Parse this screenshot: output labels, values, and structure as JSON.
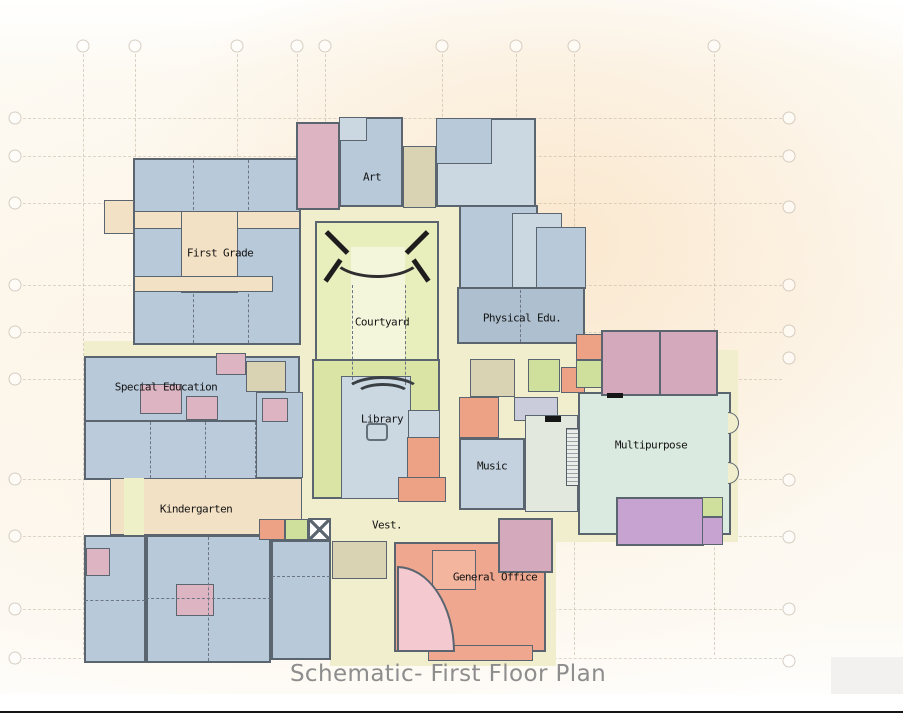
{
  "title": "Schematic- First Floor Plan",
  "colors": {
    "wall": "#5a6570",
    "cy": "#f1eecd",
    "cyl": "#eef0c8",
    "ct": "#f3e1c5",
    "bl": "#b8c9da",
    "bl2": "#bccbdb",
    "bd": "#aec0d0",
    "pb": "#cbd7e1",
    "mb": "#c3d2de",
    "pk": "#ddb4c1",
    "mv": "#d5a9bc",
    "sa": "#eda285",
    "so": "#efa78f",
    "so2": "#f3b59e",
    "cg": "#e9eebd",
    "cgl": "#f4f6dc",
    "lg": "#dae4a4",
    "li": "#cfe09c",
    "tl": "#dbeae0",
    "sg": "#e2e8de",
    "pu": "#c6a3d1",
    "lv": "#caccdb",
    "kh": "#d9d3b4",
    "gr": "#f2f1ef",
    "white": "#ffffff",
    "grid": "#bdb19e",
    "title_gray": "#8d8d8d",
    "label_black": "#141414"
  },
  "plan": {
    "grid": {
      "vx": [
        83,
        135,
        237,
        297,
        325,
        442,
        516,
        574,
        714
      ],
      "vy0": 54,
      "vy1": 655,
      "top_cy": 46,
      "hy": [
        118,
        156,
        203,
        285,
        332,
        379,
        479,
        536,
        609,
        658
      ],
      "hx0": 23,
      "hx1": 782,
      "left_cx": 15,
      "right_cx": 789,
      "right_hy": [
        118,
        156,
        207,
        285,
        331,
        358,
        480,
        537,
        609,
        661
      ]
    },
    "blocks": [
      {
        "id": "corridor-central",
        "x": 296,
        "y": 198,
        "w": 168,
        "h": 366,
        "f": "cy",
        "b": 1
      },
      {
        "id": "corridor-ew",
        "x": 84,
        "y": 341,
        "w": 556,
        "h": 22,
        "f": "cy",
        "b": 0
      },
      {
        "id": "corridor-art-east",
        "x": 436,
        "y": 138,
        "w": 50,
        "h": 208,
        "f": "cy",
        "b": 0
      },
      {
        "id": "base-south-center",
        "x": 330,
        "y": 494,
        "w": 226,
        "h": 172,
        "f": "cy",
        "b": 0
      },
      {
        "id": "base-east",
        "x": 440,
        "y": 350,
        "w": 298,
        "h": 192,
        "f": "cy",
        "b": 0
      },
      {
        "id": "corridor-fg-west",
        "x": 104,
        "y": 200,
        "w": 32,
        "h": 34,
        "f": "ct",
        "b": 1
      },
      {
        "id": "first-grade-block",
        "x": 133,
        "y": 158,
        "w": 168,
        "h": 187,
        "f": "bl",
        "b": 2
      },
      {
        "id": "fg-corridor-h1",
        "x": 134,
        "y": 211,
        "w": 166,
        "h": 18,
        "f": "ct",
        "b": 1
      },
      {
        "id": "fg-corridor-v",
        "x": 181,
        "y": 211,
        "w": 57,
        "h": 82,
        "f": "ct",
        "b": 1
      },
      {
        "id": "fg-corridor-h2",
        "x": 134,
        "y": 276,
        "w": 139,
        "h": 16,
        "f": "ct",
        "b": 1
      },
      {
        "id": "restroom-north",
        "x": 296,
        "y": 122,
        "w": 44,
        "h": 88,
        "f": "pk",
        "b": 2,
        "hatch": "rest"
      },
      {
        "id": "art-room",
        "x": 339,
        "y": 117,
        "w": 64,
        "h": 90,
        "f": "bl",
        "b": 2
      },
      {
        "id": "art-subroom",
        "x": 339,
        "y": 117,
        "w": 28,
        "h": 24,
        "f": "pb",
        "b": 1
      },
      {
        "id": "stair-art",
        "x": 403,
        "y": 146,
        "w": 33,
        "h": 62,
        "f": "kh",
        "b": 1,
        "hatch": "stair"
      },
      {
        "id": "ne-top-block",
        "x": 436,
        "y": 118,
        "w": 100,
        "h": 89,
        "f": "pb",
        "b": 2
      },
      {
        "id": "ne-top-sub",
        "x": 436,
        "y": 118,
        "w": 56,
        "h": 46,
        "f": "bl",
        "b": 1
      },
      {
        "id": "ne-room-a",
        "x": 459,
        "y": 205,
        "w": 79,
        "h": 84,
        "f": "bl",
        "b": 2
      },
      {
        "id": "ne-room-b",
        "x": 512,
        "y": 213,
        "w": 50,
        "h": 76,
        "f": "pb",
        "b": 1
      },
      {
        "id": "ne-room-c",
        "x": 536,
        "y": 227,
        "w": 50,
        "h": 62,
        "f": "bl",
        "b": 1
      },
      {
        "id": "physical-edu-room",
        "x": 457,
        "y": 287,
        "w": 128,
        "h": 57,
        "f": "bd",
        "b": 2
      },
      {
        "id": "courtyard-area",
        "x": 315,
        "y": 221,
        "w": 124,
        "h": 176,
        "f": "cg",
        "b": 2
      },
      {
        "id": "courtyard-inner",
        "x": 351,
        "y": 247,
        "w": 54,
        "h": 132,
        "f": "cgl",
        "b": 0
      },
      {
        "id": "library-base",
        "x": 312,
        "y": 359,
        "w": 128,
        "h": 140,
        "f": "lg",
        "b": 2
      },
      {
        "id": "library-room",
        "x": 341,
        "y": 376,
        "w": 70,
        "h": 123,
        "f": "pb",
        "b": 1
      },
      {
        "id": "library-east",
        "x": 408,
        "y": 410,
        "w": 32,
        "h": 89,
        "f": "pb",
        "b": 1
      },
      {
        "id": "library-orange-room",
        "x": 407,
        "y": 437,
        "w": 33,
        "h": 62,
        "f": "sa",
        "b": 1
      },
      {
        "id": "special-ed-block",
        "x": 84,
        "y": 356,
        "w": 216,
        "h": 76,
        "f": "bl",
        "b": 2
      },
      {
        "id": "special-ed-row",
        "x": 84,
        "y": 420,
        "w": 216,
        "h": 60,
        "f": "bl2",
        "b": 2
      },
      {
        "id": "spec-pink-1",
        "x": 140,
        "y": 384,
        "w": 42,
        "h": 30,
        "f": "pk",
        "b": 1,
        "hatch": "rest"
      },
      {
        "id": "spec-pink-2",
        "x": 186,
        "y": 396,
        "w": 32,
        "h": 24,
        "f": "pk",
        "b": 1
      },
      {
        "id": "spec-pink-3",
        "x": 216,
        "y": 353,
        "w": 30,
        "h": 22,
        "f": "pk",
        "b": 1
      },
      {
        "id": "stair-special-ed",
        "x": 246,
        "y": 361,
        "w": 40,
        "h": 31,
        "f": "kh",
        "b": 1,
        "hatch": "stair"
      },
      {
        "id": "spec-east-room",
        "x": 256,
        "y": 392,
        "w": 47,
        "h": 86,
        "f": "bl",
        "b": 1
      },
      {
        "id": "spec-east-pink",
        "x": 262,
        "y": 398,
        "w": 26,
        "h": 24,
        "f": "pk",
        "b": 1
      },
      {
        "id": "kg-corridor",
        "x": 110,
        "y": 478,
        "w": 192,
        "h": 57,
        "f": "ct",
        "b": 1
      },
      {
        "id": "kg-corridor-strip",
        "x": 124,
        "y": 478,
        "w": 20,
        "h": 133,
        "f": "cyl",
        "b": 0
      },
      {
        "id": "kg-left-block",
        "x": 84,
        "y": 535,
        "w": 62,
        "h": 128,
        "f": "bl",
        "b": 2
      },
      {
        "id": "kg-left-pink",
        "x": 86,
        "y": 548,
        "w": 24,
        "h": 28,
        "f": "pk",
        "b": 1
      },
      {
        "id": "kg-main-block",
        "x": 146,
        "y": 535,
        "w": 125,
        "h": 128,
        "f": "bl",
        "b": 2
      },
      {
        "id": "kg-center-pink",
        "x": 176,
        "y": 584,
        "w": 38,
        "h": 32,
        "f": "pk",
        "b": 1,
        "hatch": "rest"
      },
      {
        "id": "kg-east-block",
        "x": 271,
        "y": 540,
        "w": 60,
        "h": 120,
        "f": "bl",
        "b": 2
      },
      {
        "id": "vest-salmon-room",
        "x": 259,
        "y": 519,
        "w": 26,
        "h": 21,
        "f": "sa",
        "b": 1
      },
      {
        "id": "vest-green-room",
        "x": 285,
        "y": 519,
        "w": 23,
        "h": 21,
        "f": "li",
        "b": 1
      },
      {
        "id": "stair-vest",
        "x": 332,
        "y": 541,
        "w": 55,
        "h": 38,
        "f": "kh",
        "b": 1,
        "hatch": "stair"
      },
      {
        "id": "go-salmon-top",
        "x": 398,
        "y": 477,
        "w": 48,
        "h": 25,
        "f": "sa",
        "b": 1
      },
      {
        "id": "general-office-block",
        "x": 394,
        "y": 542,
        "w": 152,
        "h": 110,
        "f": "so",
        "b": 2
      },
      {
        "id": "go-lower-ext",
        "x": 428,
        "y": 645,
        "w": 105,
        "h": 16,
        "f": "so",
        "b": 1
      },
      {
        "id": "go-inner-room",
        "x": 432,
        "y": 550,
        "w": 44,
        "h": 40,
        "f": "so2",
        "b": 1
      },
      {
        "id": "go-restroom",
        "x": 498,
        "y": 518,
        "w": 55,
        "h": 55,
        "f": "mv",
        "b": 2,
        "hatch": "rest"
      },
      {
        "id": "stair-music",
        "x": 470,
        "y": 359,
        "w": 45,
        "h": 38,
        "f": "kh",
        "b": 1,
        "hatch": "stair"
      },
      {
        "id": "music-salmon-room",
        "x": 459,
        "y": 397,
        "w": 40,
        "h": 41,
        "f": "sa",
        "b": 1
      },
      {
        "id": "music-lavender-room",
        "x": 514,
        "y": 397,
        "w": 44,
        "h": 24,
        "f": "lv",
        "b": 1
      },
      {
        "id": "music-green-room",
        "x": 528,
        "y": 359,
        "w": 32,
        "h": 33,
        "f": "li",
        "b": 1
      },
      {
        "id": "east-salmon-small",
        "x": 561,
        "y": 367,
        "w": 24,
        "h": 26,
        "f": "sa",
        "b": 1
      },
      {
        "id": "east-green-small",
        "x": 602,
        "y": 358,
        "w": 22,
        "h": 20,
        "f": "li",
        "b": 1
      },
      {
        "id": "east-lavender-small",
        "x": 602,
        "y": 376,
        "w": 22,
        "h": 16,
        "f": "lv",
        "b": 1
      },
      {
        "id": "music-room",
        "x": 459,
        "y": 438,
        "w": 66,
        "h": 72,
        "f": "mb",
        "b": 2
      },
      {
        "id": "stage-area",
        "x": 525,
        "y": 415,
        "w": 53,
        "h": 97,
        "f": "sg",
        "b": 1
      },
      {
        "id": "multipurpose-room",
        "x": 578,
        "y": 392,
        "w": 153,
        "h": 143,
        "f": "tl",
        "b": 2
      },
      {
        "id": "mp-restrooms",
        "x": 601,
        "y": 330,
        "w": 117,
        "h": 66,
        "f": "mv",
        "b": 2,
        "hatch": "rest"
      },
      {
        "id": "mp-salmon-small",
        "x": 576,
        "y": 334,
        "w": 26,
        "h": 26,
        "f": "sa",
        "b": 1
      },
      {
        "id": "mp-green-small",
        "x": 576,
        "y": 360,
        "w": 26,
        "h": 28,
        "f": "li",
        "b": 1
      },
      {
        "id": "stage-room-purple",
        "x": 616,
        "y": 497,
        "w": 88,
        "h": 49,
        "f": "pu",
        "b": 2
      },
      {
        "id": "purple-green-small",
        "x": 702,
        "y": 497,
        "w": 21,
        "h": 20,
        "f": "li",
        "b": 1
      },
      {
        "id": "purple-east-small",
        "x": 702,
        "y": 517,
        "w": 21,
        "h": 28,
        "f": "pu",
        "b": 1
      },
      {
        "id": "corner-gray-block",
        "x": 831,
        "y": 657,
        "w": 72,
        "h": 54,
        "f": "gr",
        "b": 0
      },
      {
        "id": "bottom-margin",
        "x": 0,
        "y": 694,
        "w": 903,
        "h": 28,
        "f": "white",
        "b": 0
      }
    ],
    "decor": [
      {
        "id": "courtyard-arc-top",
        "k": "arcB",
        "x": 330,
        "y": 230,
        "w": 94,
        "h": 48
      },
      {
        "id": "courtyard-wall-bar-1",
        "k": "bar",
        "x": 322,
        "y": 240,
        "w": 30,
        "h": 5,
        "r": 45
      },
      {
        "id": "courtyard-wall-bar-2",
        "k": "bar",
        "x": 402,
        "y": 240,
        "w": 30,
        "h": 5,
        "r": -45
      },
      {
        "id": "courtyard-wall-bar-3",
        "k": "bar",
        "x": 320,
        "y": 268,
        "w": 26,
        "h": 5,
        "r": -55
      },
      {
        "id": "courtyard-wall-bar-4",
        "k": "bar",
        "x": 408,
        "y": 268,
        "w": 26,
        "h": 5,
        "r": 55
      },
      {
        "id": "courtyard-dash-left",
        "k": "vdash",
        "x": 352,
        "y": 285,
        "h": 100
      },
      {
        "id": "courtyard-dash-right",
        "k": "vdash",
        "x": 405,
        "y": 285,
        "h": 100
      },
      {
        "id": "amphitheater-arc-outer",
        "k": "arcT",
        "x": 344,
        "y": 376,
        "w": 78,
        "h": 34
      },
      {
        "id": "amphitheater-arc-inner",
        "k": "arcT",
        "x": 355,
        "y": 383,
        "w": 56,
        "h": 24
      },
      {
        "id": "library-table-icon",
        "k": "table",
        "x": 366,
        "y": 423,
        "w": 22,
        "h": 18
      },
      {
        "id": "fg-dash-1",
        "k": "vdash",
        "x": 193,
        "y": 160,
        "h": 50
      },
      {
        "id": "fg-dash-2",
        "k": "vdash",
        "x": 248,
        "y": 160,
        "h": 50
      },
      {
        "id": "fg-dash-3",
        "k": "vdash",
        "x": 193,
        "y": 294,
        "h": 49
      },
      {
        "id": "fg-dash-4",
        "k": "vdash",
        "x": 248,
        "y": 294,
        "h": 49
      },
      {
        "id": "spec-dash-1",
        "k": "vdash",
        "x": 150,
        "y": 422,
        "h": 56
      },
      {
        "id": "spec-dash-2",
        "k": "vdash",
        "x": 205,
        "y": 422,
        "h": 56
      },
      {
        "id": "spec-dash-3",
        "k": "vdash",
        "x": 255,
        "y": 422,
        "h": 56
      },
      {
        "id": "physed-dash",
        "k": "vdash",
        "x": 520,
        "y": 290,
        "h": 52
      },
      {
        "id": "kg-dash-1",
        "k": "vdash",
        "x": 208,
        "y": 537,
        "h": 124
      },
      {
        "id": "kg-dash-2",
        "k": "hdash",
        "x": 146,
        "y": 598,
        "w": 125
      },
      {
        "id": "kg-east-dash",
        "k": "hdash",
        "x": 272,
        "y": 576,
        "w": 58
      },
      {
        "id": "kg-left-dash",
        "k": "hdash",
        "x": 85,
        "y": 600,
        "w": 60
      },
      {
        "id": "stair-xbox",
        "k": "xbox",
        "x": 308,
        "y": 518,
        "w": 23,
        "h": 23
      },
      {
        "id": "entry-wedge",
        "k": "wedge",
        "x": 397,
        "y": 566,
        "w": 58,
        "h": 86
      },
      {
        "id": "stage-stairs-strip",
        "k": "shatch",
        "x": 566,
        "y": 428,
        "w": 13,
        "h": 58
      },
      {
        "id": "stage-mark",
        "k": "mark",
        "x": 545,
        "y": 416,
        "w": 16,
        "h": 6
      },
      {
        "id": "mp-mark",
        "k": "mark",
        "x": 607,
        "y": 393,
        "w": 16,
        "h": 5
      },
      {
        "id": "mp-rest-divider",
        "k": "wallv",
        "x": 659,
        "y": 331,
        "h": 64
      },
      {
        "id": "mp-door-bump-1",
        "k": "bump",
        "x": 728,
        "y": 412,
        "w": 11,
        "h": 22
      },
      {
        "id": "mp-door-bump-2",
        "k": "bump",
        "x": 728,
        "y": 462,
        "w": 11,
        "h": 22
      },
      {
        "id": "bottom-rule",
        "k": "mark",
        "x": 0,
        "y": 711,
        "w": 903,
        "h": 2
      }
    ],
    "labels": [
      {
        "id": "label-first-grade",
        "t": "First Grade",
        "x": 220,
        "y": 253
      },
      {
        "id": "label-art",
        "t": "Art",
        "x": 372,
        "y": 177
      },
      {
        "id": "label-courtyard",
        "t": "Courtyard",
        "x": 382,
        "y": 322
      },
      {
        "id": "label-physical-edu",
        "t": "Physical Edu.",
        "x": 522,
        "y": 318
      },
      {
        "id": "label-special-education",
        "t": "Special Education",
        "x": 166,
        "y": 387
      },
      {
        "id": "label-library",
        "t": "Library",
        "x": 382,
        "y": 419
      },
      {
        "id": "label-kindergarten",
        "t": "Kindergarten",
        "x": 196,
        "y": 509
      },
      {
        "id": "label-music",
        "t": "Music",
        "x": 492,
        "y": 466
      },
      {
        "id": "label-multipurpose",
        "t": "Multipurpose",
        "x": 651,
        "y": 445
      },
      {
        "id": "label-vest",
        "t": "Vest.",
        "x": 387,
        "y": 525
      },
      {
        "id": "label-general-office",
        "t": "General Office",
        "x": 495,
        "y": 577
      }
    ],
    "title_pos": {
      "x": 448,
      "y": 674
    }
  }
}
